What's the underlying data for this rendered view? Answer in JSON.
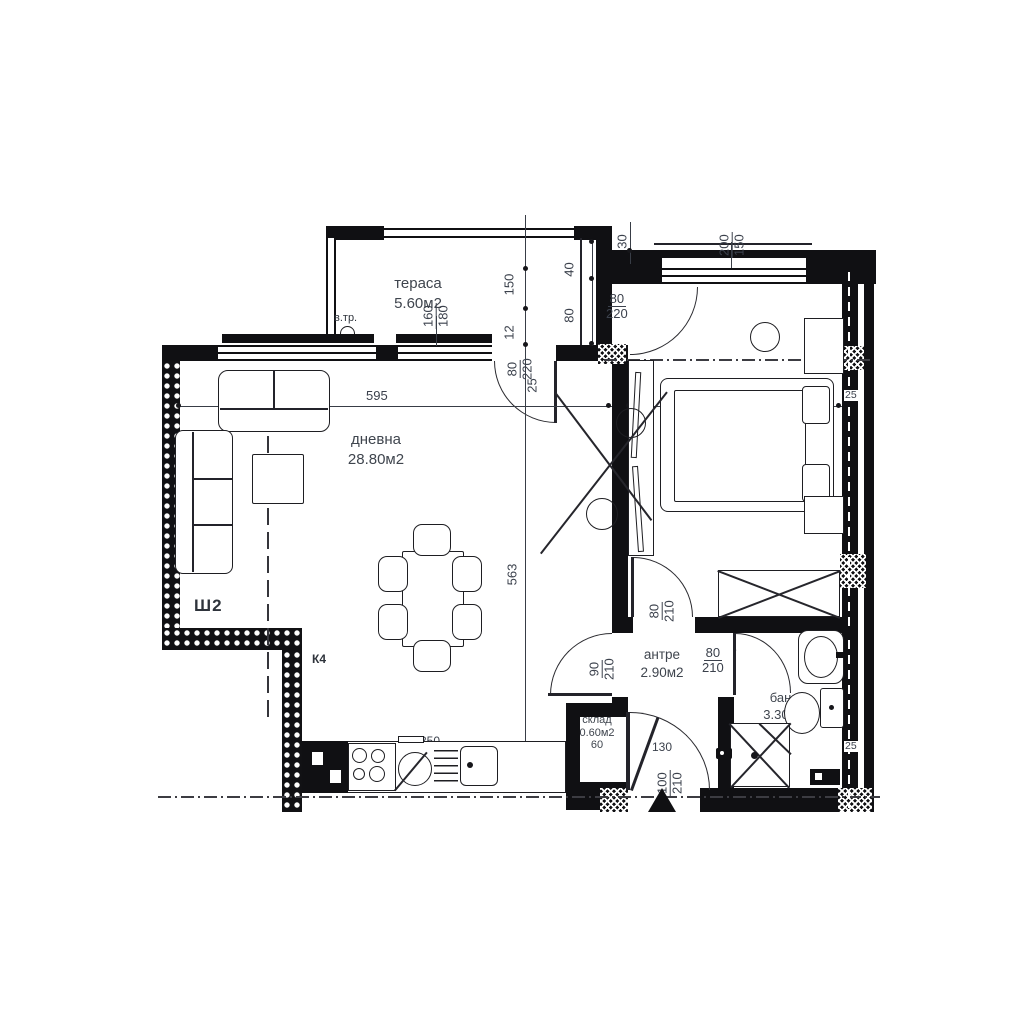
{
  "plan": {
    "rooms": {
      "terrace": {
        "name": "тераса",
        "area": "5.60м2"
      },
      "living": {
        "name": "дневна",
        "area": "28.80м2"
      },
      "bedroom": {
        "name": "спалня",
        "area": "13.20м2"
      },
      "hall": {
        "name": "антре",
        "area": "2.90м2"
      },
      "bath": {
        "name": "баня",
        "area": "3.30м2"
      },
      "storage": {
        "name": "склад",
        "area": "0.60м2"
      }
    },
    "marks": {
      "vtr": "в.тр.",
      "sh2": "Ш2",
      "k4": "К4",
      "star": "*",
      "arrow_up": "↑"
    },
    "dims": {
      "living_width": "595",
      "bed_width": "293",
      "living_height": "563",
      "terrace_150": "150",
      "terrace_12": "12",
      "off_40": "40",
      "off_80": "80",
      "off_30": "30",
      "wall_25_bedroom": "25",
      "wall_25_bath": "25",
      "hall_130": "130",
      "bath_131": "131",
      "kitchen_350": "350",
      "storage_60": "60",
      "win_terrace": {
        "w": "160",
        "h": "180"
      },
      "win_bedroom": {
        "w": "200",
        "h": "150"
      },
      "door_terrace": {
        "w": "80",
        "h": "220",
        "off": "25"
      },
      "door_bedroom_top": {
        "w": "80",
        "h": "220"
      },
      "door_living_hall": {
        "w": "90",
        "h": "210"
      },
      "door_bedroom_hall": {
        "w": "80",
        "h": "210"
      },
      "door_bath": {
        "w": "80",
        "h": "210"
      },
      "door_entrance": {
        "w": "100",
        "h": "210"
      }
    }
  }
}
